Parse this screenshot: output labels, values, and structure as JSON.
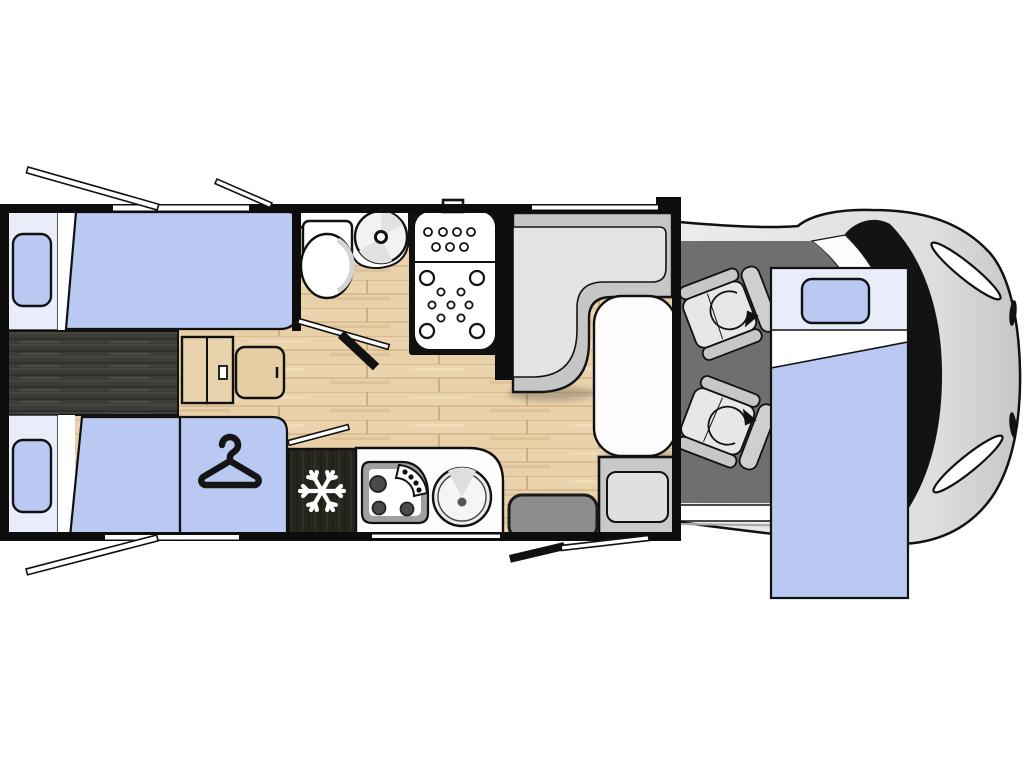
{
  "diagram": {
    "kind": "motorhome-floor-plan-top-view",
    "orientation": "vehicle front (cab) on the right, rear bedroom on the left",
    "zones": {
      "rear_bedroom": {
        "label": "rear twin beds",
        "beds": 2,
        "features": [
          "two single beds with pillows",
          "dark wood center chest/walkway",
          "step unit with handle",
          "bedside cabinet",
          "wardrobe with hanger symbol"
        ]
      },
      "bathroom": {
        "label": "washroom",
        "features": [
          "toilet",
          "round wash basin on counter",
          "shower cubicle with jet pattern",
          "open door symbol"
        ]
      },
      "kitchen": {
        "label": "kitchenette",
        "features": [
          "refrigerator with snowflake symbol",
          "three-burner hob",
          "round sink",
          "worktop"
        ]
      },
      "dinette": {
        "label": "L-shaped lounge seating",
        "features": [
          "L-shaped bench",
          "oval white table",
          "extra bench seat",
          "entry step",
          "entry door symbol"
        ]
      },
      "cab": {
        "label": "driver cab",
        "swivel_seats": 2,
        "features": [
          "two swivelling captain chairs with rotation arrows",
          "dashboard",
          "windshield",
          "headlights"
        ]
      },
      "dropdown_bed": {
        "label": "drop-down / pull-down front bed",
        "beds": 1,
        "features": [
          "pillow",
          "blanket",
          "overlaps cab seats"
        ]
      }
    },
    "symbols": [
      "hanger-icon",
      "snowflake-icon",
      "swivel-arrow-icon",
      "open-window-bars",
      "open-door-bars"
    ]
  },
  "colors": {
    "bed_blue": "#b9c9f2",
    "bed_head": "#e9edfa",
    "white": "#ffffff",
    "wall_black": "#0d0d0d",
    "wood_floor": "#e8d0a8",
    "wood_floor_line": "#d3b68c",
    "dark_wood": "#3d3d38",
    "fridge_dark": "#26261f",
    "furniture_wood": "#e5cda4",
    "bench_light": "#e3e3e3",
    "bench_mid": "#c6c6c6",
    "cab_floor": "#6f6f6f",
    "body_gray": "#e2e2e2",
    "step_gray": "#8d8d8d",
    "seat_gray": "#e7e7e7",
    "table_white": "#fcfcfc"
  }
}
